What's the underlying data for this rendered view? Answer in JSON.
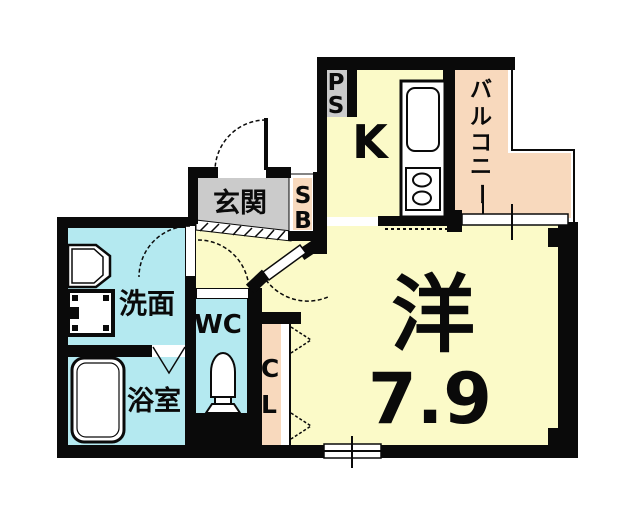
{
  "floorplan": {
    "rooms": {
      "kitchen": {
        "label": "K"
      },
      "balcony": {
        "label": "バルコニー",
        "chars": [
          "バ",
          "ル",
          "コ",
          "ニ",
          "ー"
        ]
      },
      "entrance": {
        "label": "玄関"
      },
      "shoe_box": {
        "label": "SB",
        "chars": [
          "S",
          "B"
        ]
      },
      "pipe_space": {
        "label": "PS",
        "chars": [
          "P",
          "S"
        ]
      },
      "washroom": {
        "label": "洗面"
      },
      "toilet": {
        "label": "WC"
      },
      "bathroom": {
        "label": "浴室"
      },
      "closet": {
        "label": "CL",
        "chars": [
          "C",
          "L"
        ]
      },
      "main_room": {
        "label": "洋",
        "size": "7.9"
      }
    },
    "colors": {
      "room_yellow": "#FBFAC8",
      "wet_area_cyan": "#B4E9F0",
      "balcony_peach": "#F8D9BD",
      "entrance_gray": "#CBCBCB",
      "wall_black": "#0A0A0A"
    }
  }
}
